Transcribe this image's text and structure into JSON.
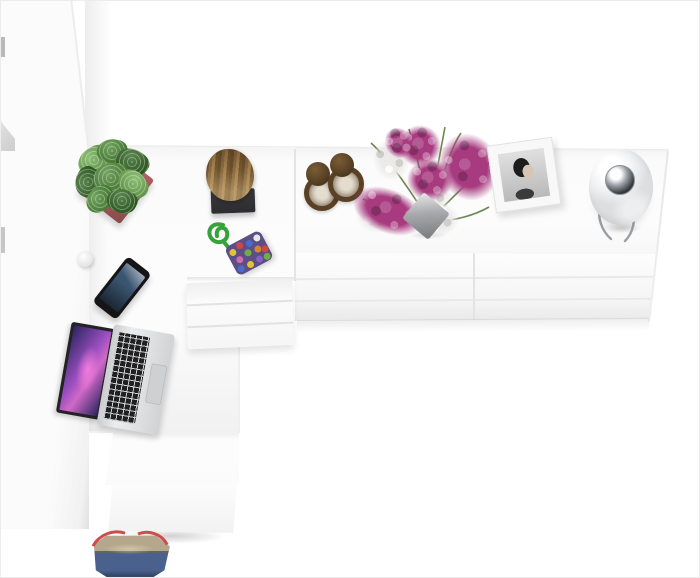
{
  "scene": {
    "description": "Top-down 3D render of a white L-shaped home-office set: tall wardrobe, corner desk with three-drawer pedestal, and a long six-drawer sideboard, styled with decor objects",
    "furniture": {
      "wardrobe": {
        "label": "white wardrobe cabinet, top view"
      },
      "desk": {
        "label": "white corner desk top"
      },
      "pedestal": {
        "label": "three-drawer desk pedestal",
        "drawer_count": 3
      },
      "sideboard": {
        "label": "white sideboard with six drawers",
        "drawer_rows": 3,
        "drawer_columns": 2
      },
      "step_panel": {
        "label": "desk return panel"
      },
      "lower_cabinet": {
        "label": "white lower cabinet"
      }
    },
    "objects": {
      "plant": {
        "label": "green succulent plant in rose square pot"
      },
      "stool": {
        "label": "natural wood log stool on black base"
      },
      "hourglasses": {
        "label": "two brass hourglasses"
      },
      "bouquet": {
        "label": "magenta and white orchid bouquet in metal cube vase"
      },
      "frame": {
        "label": "white photo frame with black-and-white portrait"
      },
      "lamp": {
        "label": "glossy white sphere table lamp with chrome eye"
      },
      "keychain": {
        "label": "multicolour pompom pouch with green cord"
      },
      "grommet": {
        "label": "white desk hook"
      },
      "phone": {
        "label": "black smartphone lying on desk"
      },
      "laptop": {
        "label": "open silver laptop with purple wallpaper"
      },
      "bag": {
        "label": "blue and beige tote bag with red straps"
      }
    },
    "colors": {
      "wall": "#ffffff",
      "furniture": "#fbfbfb",
      "edge": "#e4e4e4",
      "pot": "#ac5f5e",
      "leaf": "#4c8a36",
      "leaf_light": "#6fae52",
      "leaf_dark": "#2f6420",
      "wood": "#8a6a42",
      "wood_dark": "#6b5130",
      "wood_light": "#a5824e",
      "stool_base": "#2d2d2f",
      "brass": "#5a4126",
      "brass_dark": "#3a2a16",
      "sand": "#e4dccd",
      "magenta": "#a83b80",
      "flower_white": "#eceae9",
      "stem": "#5f7a3f",
      "vase": "#a7a8ab",
      "frame": "#f8f8f8",
      "photo_bg": "#cfcfcf",
      "portrait": "#1d1d1d",
      "lamp": "#dcdee0",
      "chrome": "#34393d",
      "cord": "#35a23c",
      "pouch": "#5d4f86",
      "phone": "#151517",
      "phone_screen": "#3a5570",
      "laptop": "#d9dbdd",
      "keys": "#202022",
      "wallpaper_a": "#9a4fc0",
      "wallpaper_b": "#2c2560",
      "denim": "#49618c",
      "khaki": "#b5a78b",
      "strap": "#d14b4b"
    }
  }
}
